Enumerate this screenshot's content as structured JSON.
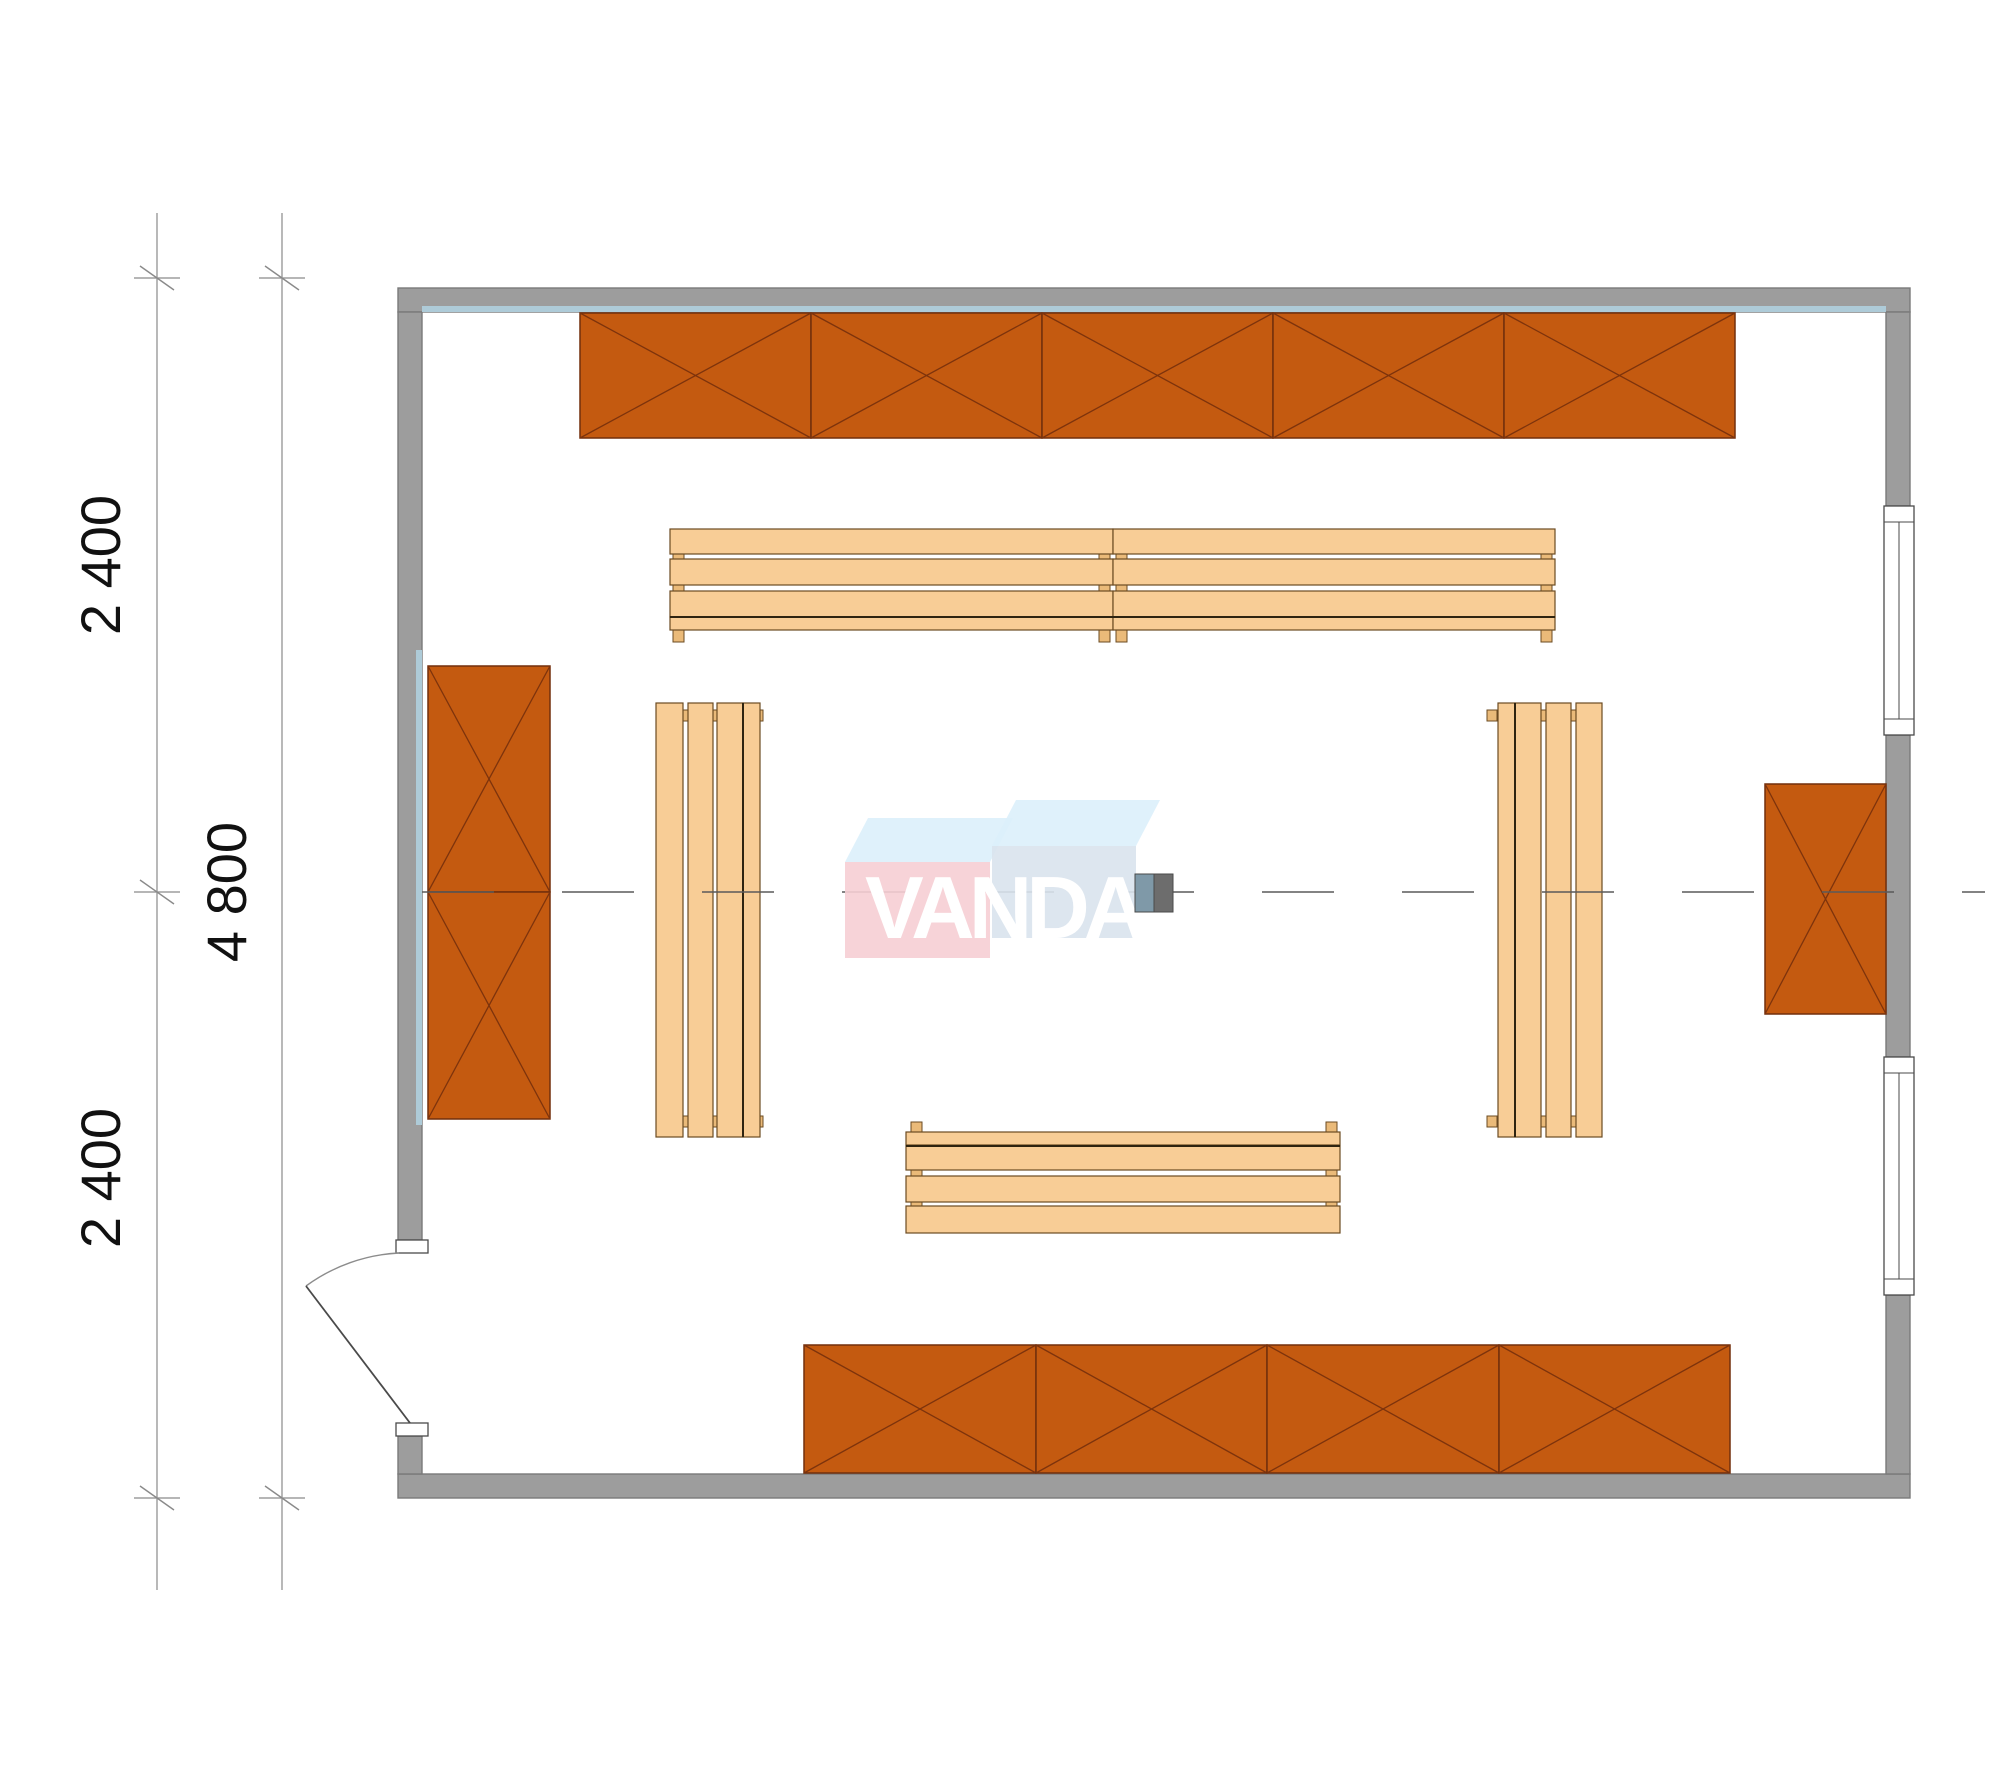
{
  "canvas": {
    "w": 2000,
    "h": 1786
  },
  "colors": {
    "bg": "#ffffff",
    "wall": "#9d9d9d",
    "wall_stroke": "#7a7a7a",
    "wall_accent": "#aecbd8",
    "shelf_fill": "#c45a10",
    "shelf_stroke": "#722f0c",
    "shelf_x": "#7d330c",
    "bench_fill": "#f8cd96",
    "bench_stroke": "#6b4b22",
    "bench_join": "#2f2410",
    "foot_fill": "#eaba79",
    "centerline": "#5a5a5a",
    "dim_line": "#8a8a8a",
    "dim_text": "#111111",
    "door_fill": "#ffffff",
    "door_stroke": "#4a4a4a",
    "arc_stroke": "#8c8c8c",
    "wm_pink": "#f6ced4",
    "wm_pink_top": "#dceffb",
    "wm_blue": "#d9e3ed",
    "wm_blue_top": "#dcf0fb",
    "wm_text": "#ffffff",
    "col_left": "#7f99a8",
    "col_right": "#6d6d6d",
    "col_stroke": "#4a4a4a"
  },
  "watermark": {
    "text": "VANDA",
    "x": 865,
    "y": 938,
    "size": 88,
    "spacing": -6,
    "pink_front": {
      "x": 845,
      "y": 862,
      "w": 145,
      "h": 96
    },
    "blue_front": {
      "x": 992,
      "y": 846,
      "w": 144,
      "h": 92
    },
    "pink_top": "845,862 990,862 1013,818 868,818",
    "blue_top": "992,846 1136,846 1160,800 1016,800"
  },
  "dimensions": {
    "labels": [
      {
        "text": "2 400",
        "x": 120,
        "y": 565
      },
      {
        "text": "4 800",
        "x": 246,
        "y": 892
      },
      {
        "text": "2 400",
        "x": 120,
        "y": 1178
      }
    ],
    "lines": [
      {
        "x": 157,
        "y1": 213,
        "y2": 1590
      },
      {
        "x": 282,
        "y1": 213,
        "y2": 1590
      }
    ],
    "ticks": [
      {
        "x": 157,
        "y": 278
      },
      {
        "x": 157,
        "y": 892
      },
      {
        "x": 157,
        "y": 1498
      },
      {
        "x": 282,
        "y": 278
      },
      {
        "x": 282,
        "y": 1498
      }
    ],
    "font_size": 56
  },
  "plan": {
    "walls": [
      {
        "name": "top",
        "x": 398,
        "y": 288,
        "w": 1512,
        "h": 24
      },
      {
        "name": "bottom",
        "x": 398,
        "y": 1474,
        "w": 1512,
        "h": 24
      },
      {
        "name": "left-upper",
        "x": 398,
        "y": 312,
        "w": 24,
        "h": 928
      },
      {
        "name": "left-lower",
        "x": 398,
        "y": 1436,
        "w": 24,
        "h": 38
      },
      {
        "name": "right-upper",
        "x": 1886,
        "y": 312,
        "w": 24,
        "h": 194
      },
      {
        "name": "right-mid",
        "x": 1886,
        "y": 735,
        "w": 24,
        "h": 322
      },
      {
        "name": "right-lower",
        "x": 1886,
        "y": 1295,
        "w": 24,
        "h": 179
      }
    ],
    "accents": [
      {
        "x": 422,
        "y": 306,
        "w": 1464,
        "h": 6
      },
      {
        "x": 416,
        "y": 650,
        "w": 6,
        "h": 475
      }
    ],
    "windows": [
      {
        "x": 1884,
        "y": 506,
        "w": 30,
        "h": 229,
        "cap": 16
      },
      {
        "x": 1884,
        "y": 1057,
        "w": 30,
        "h": 238,
        "cap": 16
      }
    ],
    "door": {
      "jambs": [
        {
          "x": 396,
          "y": 1240,
          "w": 32,
          "h": 13
        },
        {
          "x": 396,
          "y": 1423,
          "w": 32,
          "h": 13
        }
      ],
      "leaf": {
        "x1": 410,
        "y1": 1423,
        "x2": 306,
        "y2": 1286
      },
      "arc": "M 306 1286 A 172 172 0 0 1 399 1253"
    },
    "shelf_cells": [
      {
        "name": "shelf-top-1",
        "x": 580,
        "y": 313,
        "w": 231,
        "h": 125
      },
      {
        "name": "shelf-top-2",
        "x": 811,
        "y": 313,
        "w": 231,
        "h": 125
      },
      {
        "name": "shelf-top-3",
        "x": 1042,
        "y": 313,
        "w": 231,
        "h": 125
      },
      {
        "name": "shelf-top-4",
        "x": 1273,
        "y": 313,
        "w": 231,
        "h": 125
      },
      {
        "name": "shelf-top-5",
        "x": 1504,
        "y": 313,
        "w": 231,
        "h": 125
      },
      {
        "name": "shelf-bottom-1",
        "x": 804,
        "y": 1345,
        "w": 232,
        "h": 128
      },
      {
        "name": "shelf-bottom-2",
        "x": 1036,
        "y": 1345,
        "w": 231,
        "h": 128
      },
      {
        "name": "shelf-bottom-3",
        "x": 1267,
        "y": 1345,
        "w": 232,
        "h": 128
      },
      {
        "name": "shelf-bottom-4",
        "x": 1499,
        "y": 1345,
        "w": 231,
        "h": 128
      },
      {
        "name": "shelf-left-1",
        "x": 428,
        "y": 666,
        "w": 122,
        "h": 226
      },
      {
        "name": "shelf-left-2",
        "x": 428,
        "y": 892,
        "w": 122,
        "h": 227
      },
      {
        "name": "shelf-right-1",
        "x": 1765,
        "y": 784,
        "w": 121,
        "h": 230
      }
    ],
    "bench_slats": [
      {
        "x": 670,
        "y": 529,
        "w": 443,
        "h": 25
      },
      {
        "x": 670,
        "y": 559,
        "w": 443,
        "h": 26
      },
      {
        "x": 670,
        "y": 591,
        "w": 443,
        "h": 26
      },
      {
        "x": 670,
        "y": 617,
        "w": 443,
        "h": 13
      },
      {
        "x": 1113,
        "y": 529,
        "w": 442,
        "h": 25
      },
      {
        "x": 1113,
        "y": 559,
        "w": 442,
        "h": 26
      },
      {
        "x": 1113,
        "y": 591,
        "w": 442,
        "h": 26
      },
      {
        "x": 1113,
        "y": 617,
        "w": 442,
        "h": 13
      },
      {
        "x": 906,
        "y": 1132,
        "w": 434,
        "h": 13
      },
      {
        "x": 906,
        "y": 1146,
        "w": 434,
        "h": 24
      },
      {
        "x": 906,
        "y": 1176,
        "w": 434,
        "h": 26
      },
      {
        "x": 906,
        "y": 1206,
        "w": 434,
        "h": 27
      },
      {
        "x": 656,
        "y": 703,
        "w": 27,
        "h": 434
      },
      {
        "x": 688,
        "y": 703,
        "w": 25,
        "h": 434
      },
      {
        "x": 717,
        "y": 703,
        "w": 26,
        "h": 434
      },
      {
        "x": 743,
        "y": 703,
        "w": 17,
        "h": 434
      },
      {
        "x": 1498,
        "y": 703,
        "w": 17,
        "h": 434
      },
      {
        "x": 1515,
        "y": 703,
        "w": 26,
        "h": 434
      },
      {
        "x": 1546,
        "y": 703,
        "w": 25,
        "h": 434
      },
      {
        "x": 1576,
        "y": 703,
        "w": 26,
        "h": 434
      }
    ],
    "bench_joins": [
      {
        "x1": 670,
        "y1": 617,
        "x2": 1113,
        "y2": 617
      },
      {
        "x1": 1113,
        "y1": 617,
        "x2": 1555,
        "y2": 617
      },
      {
        "x1": 906,
        "y1": 1146,
        "x2": 1340,
        "y2": 1146
      },
      {
        "x1": 743,
        "y1": 703,
        "x2": 743,
        "y2": 1137
      },
      {
        "x1": 1515,
        "y1": 703,
        "x2": 1515,
        "y2": 1137
      }
    ],
    "bench_feet": [
      {
        "xs": [
          673,
          1099,
          1116,
          1541
        ],
        "ys": [
          551,
          583,
          630
        ],
        "w": 11,
        "h": 12
      },
      {
        "xs": [
          911,
          1326
        ],
        "ys": [
          1122,
          1168,
          1200
        ],
        "w": 11,
        "h": 12
      },
      {
        "xs": [
          681,
          712,
          753
        ],
        "ys": [
          710,
          1116
        ],
        "w": 10,
        "h": 11
      },
      {
        "xs": [
          1487,
          1538,
          1568
        ],
        "ys": [
          710,
          1116
        ],
        "w": 10,
        "h": 11
      }
    ],
    "centerline": {
      "y": 892,
      "x1": 422,
      "x2": 1985,
      "dash": "72 68"
    },
    "column": {
      "x": 1135,
      "y": 874,
      "w": 38,
      "h": 38
    }
  }
}
